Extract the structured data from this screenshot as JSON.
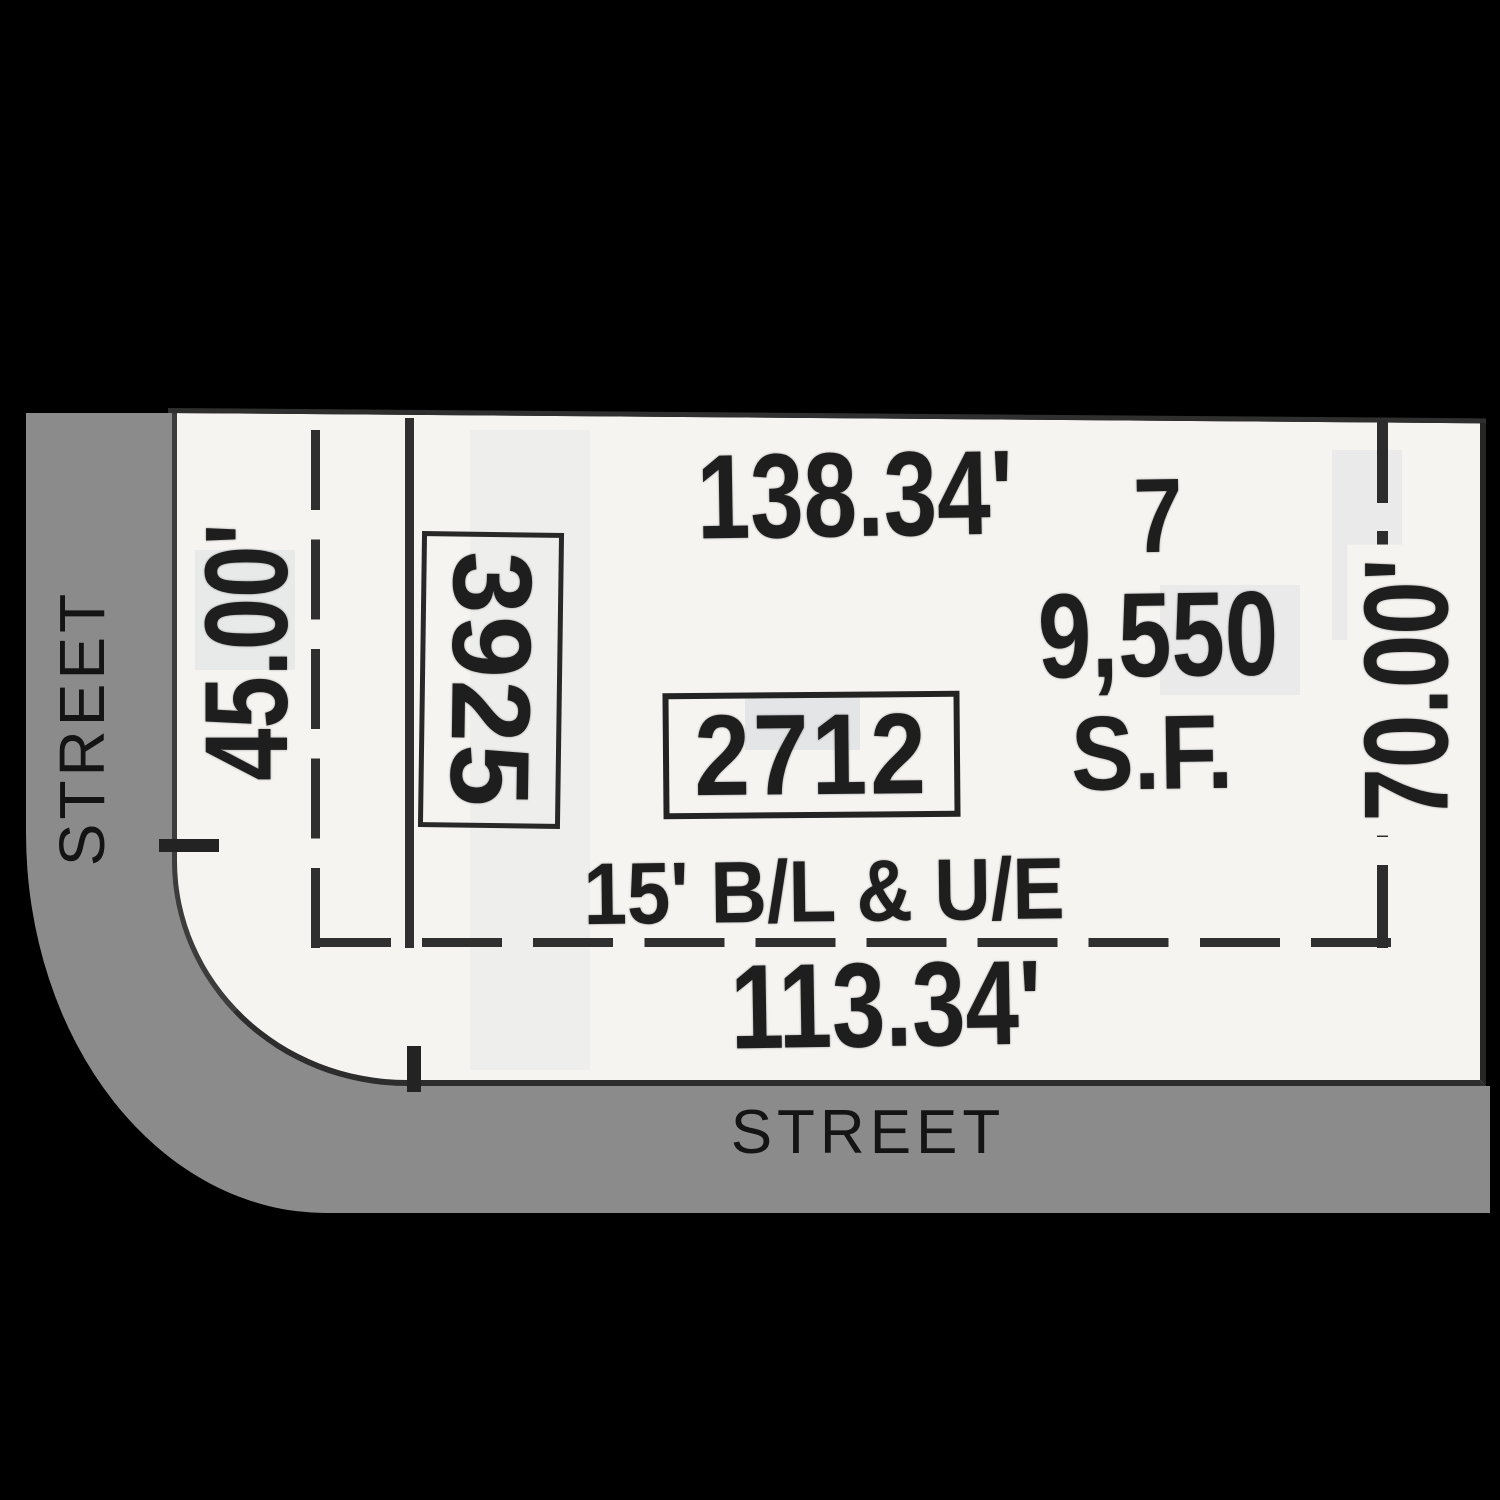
{
  "plat": {
    "streets": {
      "left": "STREET",
      "bottom": "STREET"
    },
    "dimensions": {
      "top": "138.34'",
      "bottom": "113.34'",
      "left": "45.00'",
      "right": "70.00'"
    },
    "lot": {
      "number": "7",
      "area": "9,550",
      "area_unit": "S.F."
    },
    "labels": {
      "box_vertical": "3925",
      "box_horizontal": "2712",
      "easement": "15' B/L & U/E"
    }
  },
  "colors": {
    "background": "#000000",
    "street": "#8b8b8b",
    "plat_paper": "#f5f4f1",
    "ink": "#1e1e1e"
  }
}
